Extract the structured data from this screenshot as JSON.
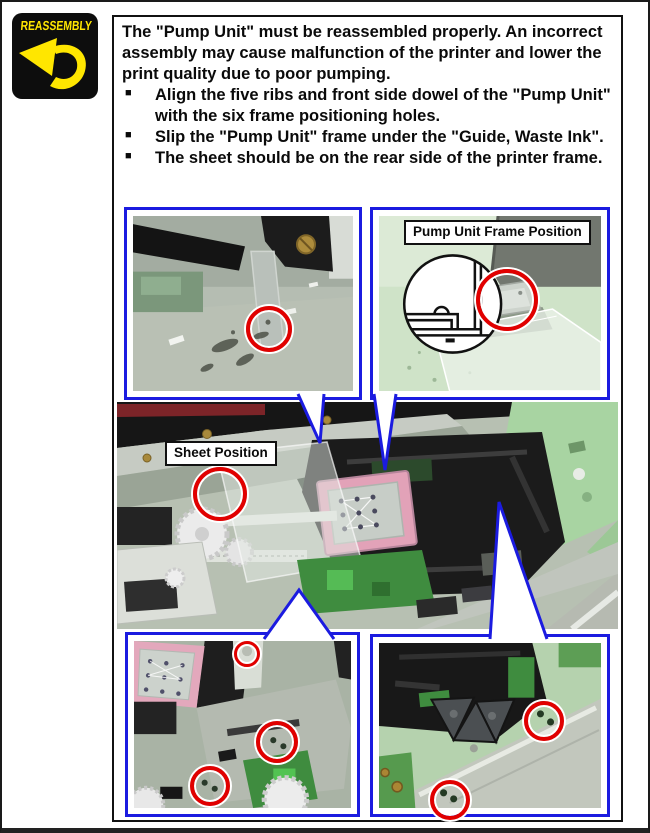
{
  "badge": {
    "label": "REASSEMBLY"
  },
  "notice": {
    "paragraph": "The \"Pump Unit\" must be reassembled properly. An incorrect assembly may cause malfunction of the printer and lower the print quality due to poor pumping.",
    "bullets": [
      "Align the five ribs and front side dowel of the \"Pump Unit\" with the six frame positioning holes.",
      "Slip the \"Pump Unit\" frame under the \"Guide, Waste Ink\".",
      "The sheet should be on the rear side of the printer frame."
    ],
    "bullet_glyph": "■"
  },
  "figures": {
    "pump_frame_label": "Pump Unit Frame Position",
    "sheet_label": "Sheet Position"
  },
  "colors": {
    "callout_blue": "#1b1be0",
    "highlight_red": "#e10000",
    "badge_yellow": "#ffe600",
    "badge_bg": "#0d0d0d"
  }
}
